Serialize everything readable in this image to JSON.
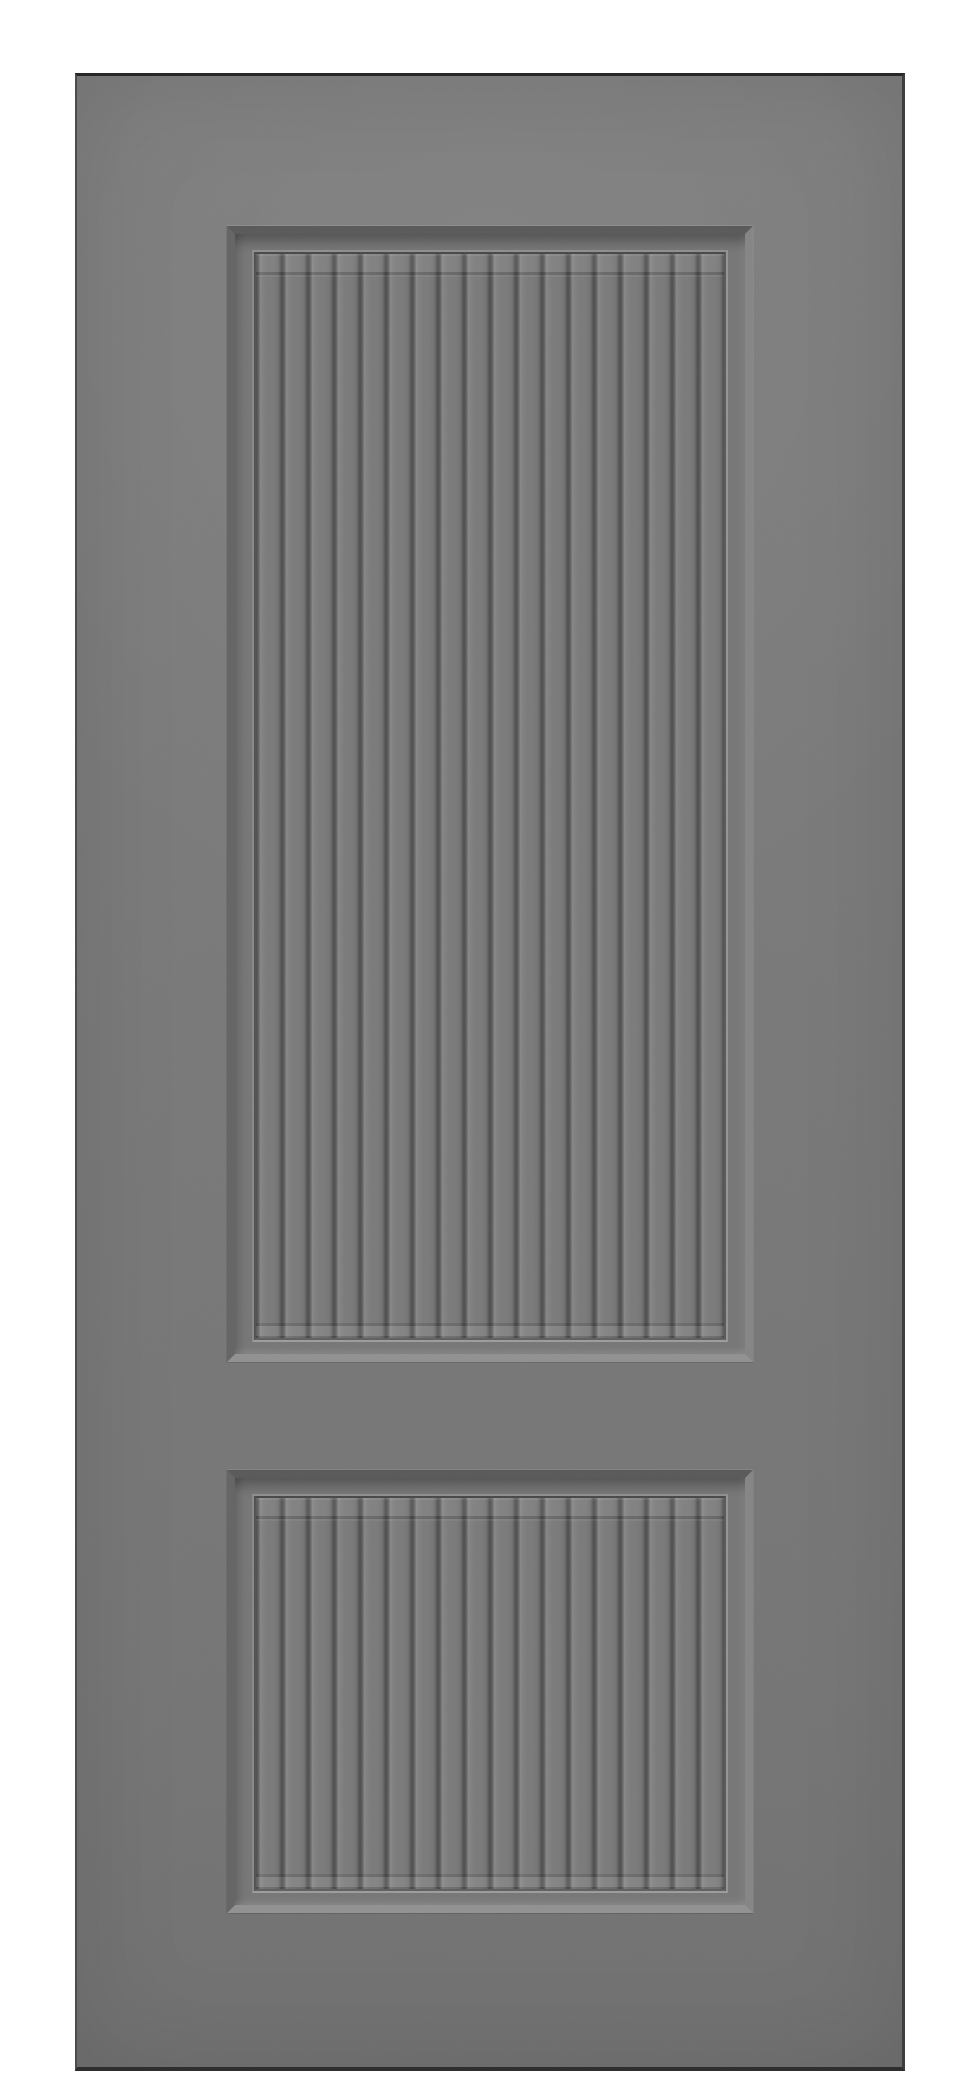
{
  "scene": {
    "description": "Product render of a grey interior door slab with two recessed fluted panels on a white background",
    "background_color": "#ffffff",
    "text_content": "none"
  },
  "door": {
    "face_color": "#7a7a7a",
    "edge_colors": {
      "top": "#272727",
      "right": "#3e3e3e",
      "bottom": "#2e2e2e",
      "left": "#4c4c4c"
    },
    "panels": [
      {
        "id": "upper",
        "style": "recessed bevel frame",
        "flute_count": 18,
        "flute_orientation": "vertical"
      },
      {
        "id": "lower",
        "style": "recessed bevel frame",
        "flute_count": 18,
        "flute_orientation": "vertical"
      }
    ],
    "groove_color": "#515151",
    "plank_color": "#7a7a7a",
    "plank_highlight_color": "#8a8a8a",
    "bevel_colors": {
      "top": "#5a5a5a",
      "left": "#656565",
      "right": "#868686",
      "bottom": "#929292"
    }
  },
  "css_vars": {
    "--bg": "#ffffff",
    "--door-left": "75px",
    "--door-top": "73px",
    "--door-w": "830px",
    "--door-h": "1998px",
    "--edge-top": "#272727",
    "--edge-right": "#3e3e3e",
    "--edge-bottom": "#2e2e2e",
    "--edge-left": "#4c4c4c",
    "--p-left": "150px",
    "--p-w": "526px",
    "--p1-top": "150px",
    "--p1-h": "1136px",
    "--p2-top": "1394px",
    "--p2-h": "443px",
    "--bev": "8px",
    "--bev-top": "#5a5a5a",
    "--bev-left": "#656565",
    "--bev-right": "#868686",
    "--bev-bottom": "#929292"
  }
}
